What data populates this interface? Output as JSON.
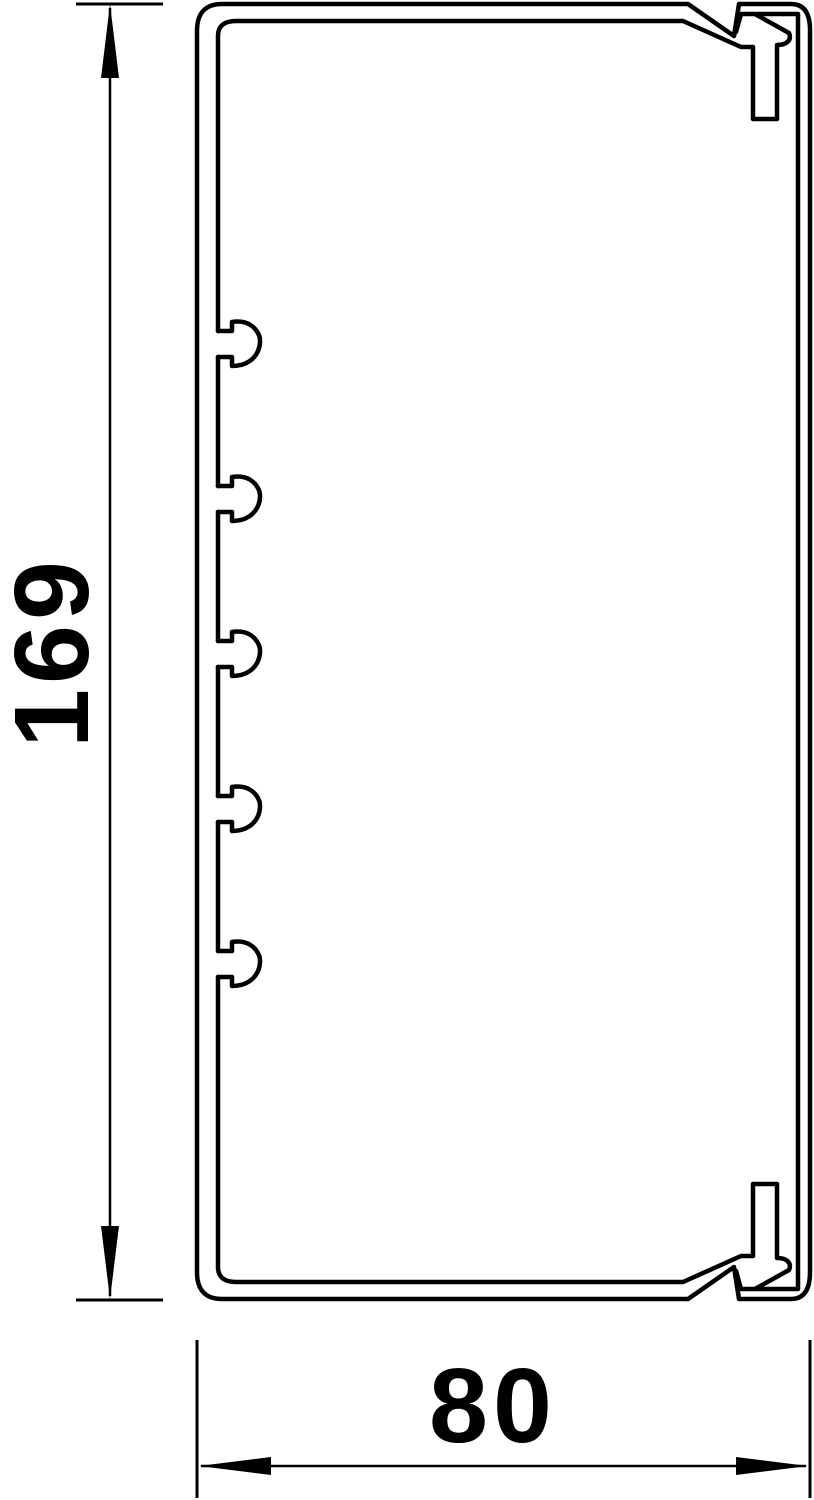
{
  "drawing": {
    "kind": "technical cross-section of cable trunking profile",
    "line_color": "#000000",
    "background_color": "#ffffff",
    "clip_count": 5
  },
  "dimensions": {
    "height": {
      "label": "169"
    },
    "width": {
      "label": "80"
    }
  }
}
